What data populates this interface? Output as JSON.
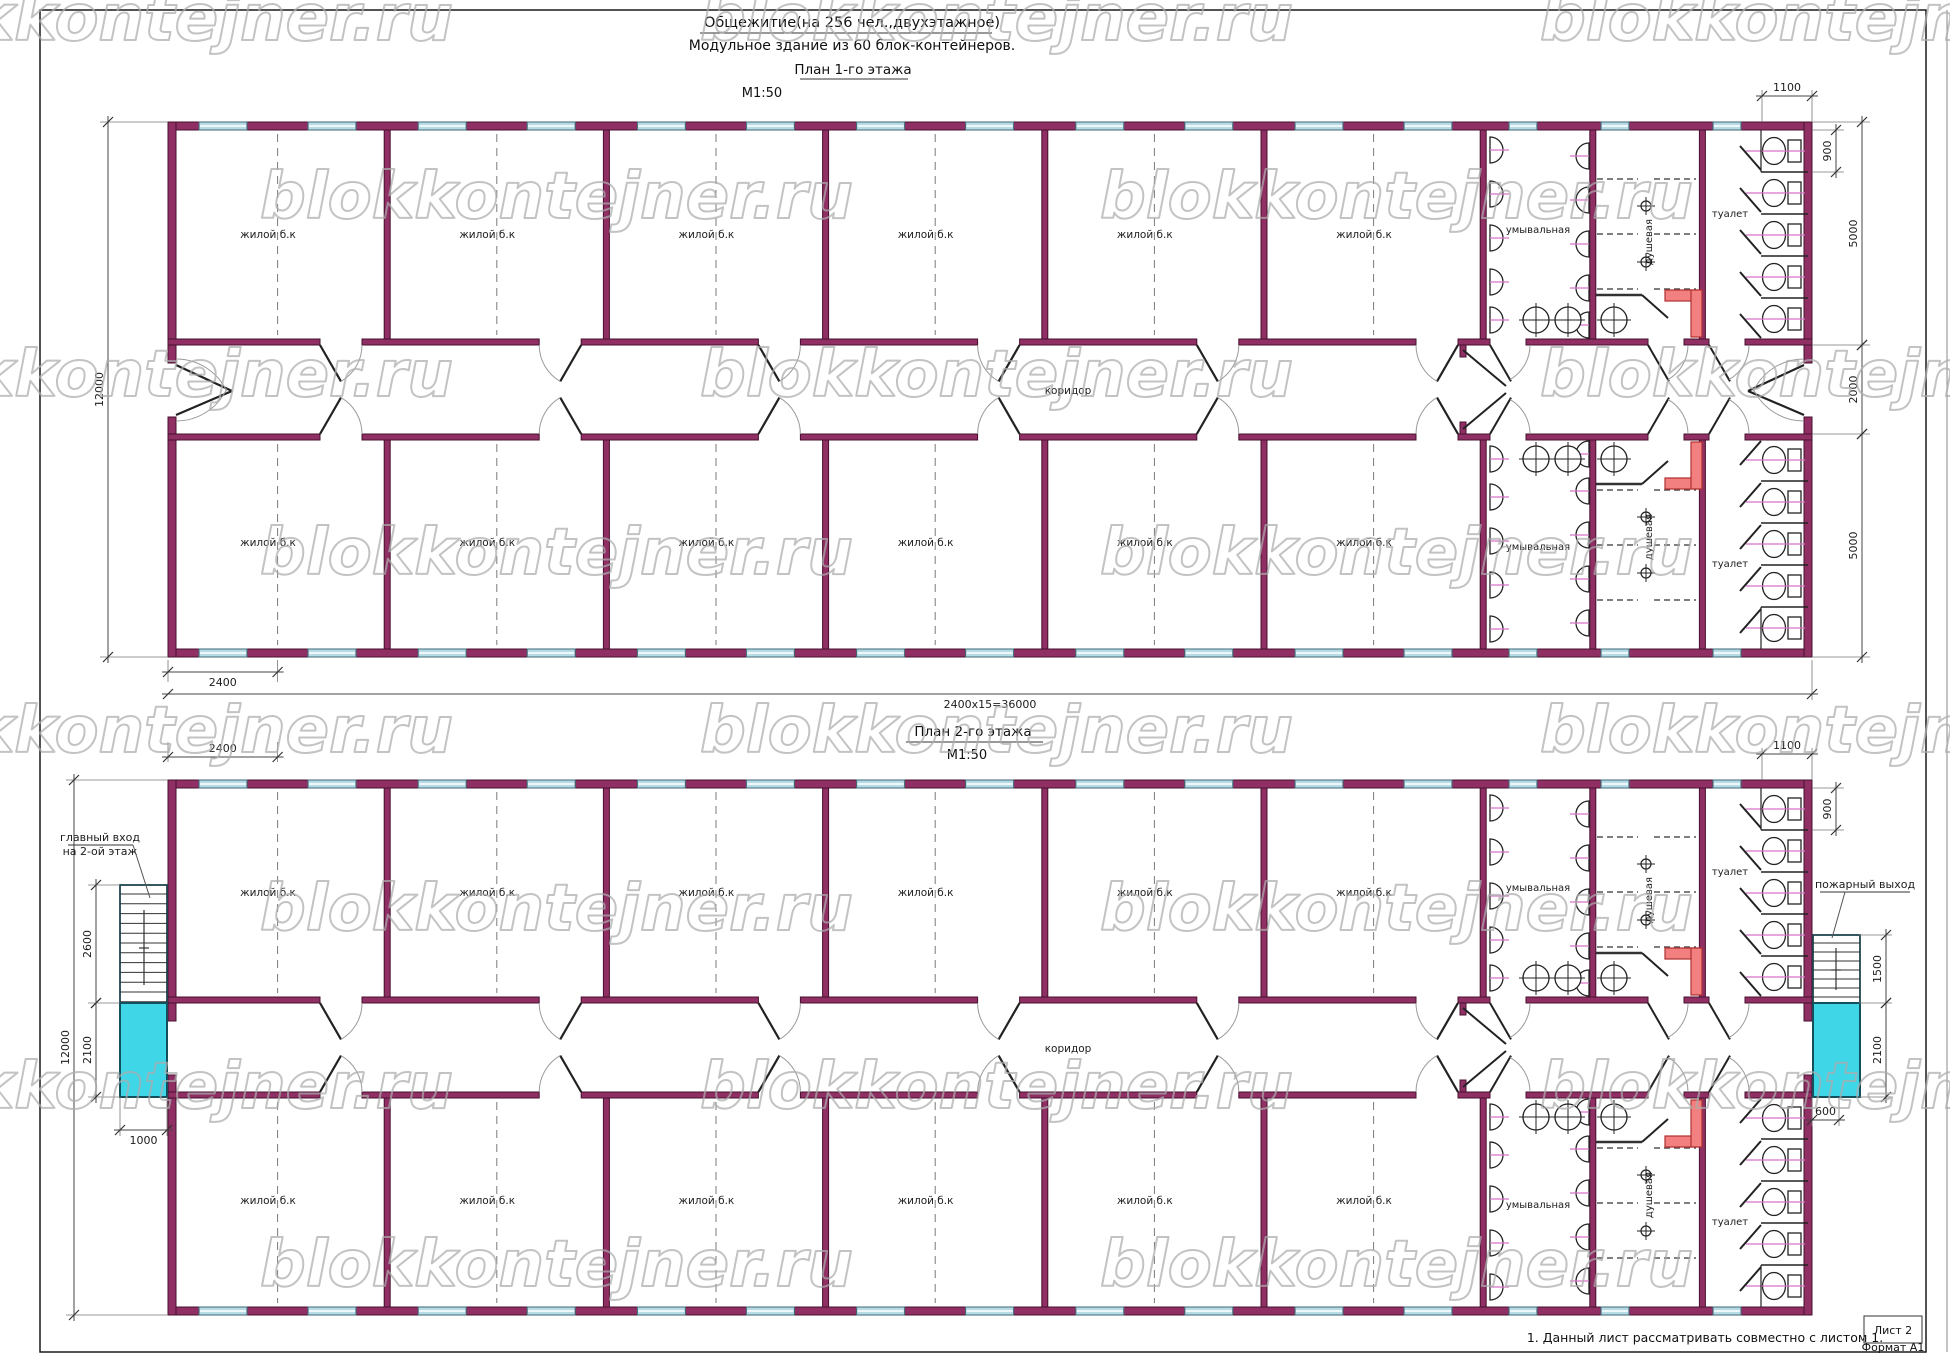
{
  "header": {
    "title_line1": "Общежитие(на 256 чел.,двухэтажное)",
    "title_line2": "Модульное  здание из 60 блок-контейнеров."
  },
  "plan1": {
    "title": "План  1-го этажа",
    "scale": "М1:50"
  },
  "plan2": {
    "title": "План  2-го этажа",
    "scale": "М1:50"
  },
  "labels": {
    "living_room": "жилой б.к",
    "corridor": "коридор",
    "washroom": "умывальная",
    "shower": "душевая",
    "toilet": "туалет",
    "main_entrance_line1": "главный вход",
    "main_entrance_line2": "на 2-ой этаж",
    "fire_exit": "пожарный выход"
  },
  "dimensions": {
    "floor1": {
      "left_total": "12000",
      "bottom_module": "2400",
      "bottom_total": "2400x15=36000",
      "right_top_width": "1100",
      "right_stall": "900",
      "right_band_top": "5000",
      "right_corridor": "2000",
      "right_band_bottom": "5000"
    },
    "floor2": {
      "top_module": "2400",
      "left_stair": "2600",
      "left_landing": "2100",
      "left_width": "1000",
      "left_total": "12000",
      "right_top_width": "1100",
      "right_stall": "900",
      "right_stair": "1500",
      "right_landing": "2100",
      "right_exit_width": "600"
    }
  },
  "notes": {
    "note1": "1. Данный лист рассматривать совместно с листом 1."
  },
  "titleblock": {
    "sheet": "Лист 2",
    "format": "Формат А1"
  },
  "watermark": {
    "text": "blokkontejner.ru"
  },
  "structure": {
    "floors": 2,
    "bands_per_floor": 2,
    "living_rooms_per_band": 6,
    "toilet_stalls_per_band": 5,
    "washbasins_per_wall": 5,
    "shower_rows_per_band": 3
  },
  "colors": {
    "wall": "#8f2f64",
    "wall_edge": "#47102f",
    "window": "#b6dbe4",
    "window_edge": "#3f6a76",
    "stair_landing": "#3fd6e8",
    "landing_edge": "#14505c",
    "accent_red": "#f28080",
    "accent_red_edge": "#b03030",
    "fixture_line": "#d873c8",
    "line": "#1c1c1c",
    "watermark": "#adadad"
  }
}
